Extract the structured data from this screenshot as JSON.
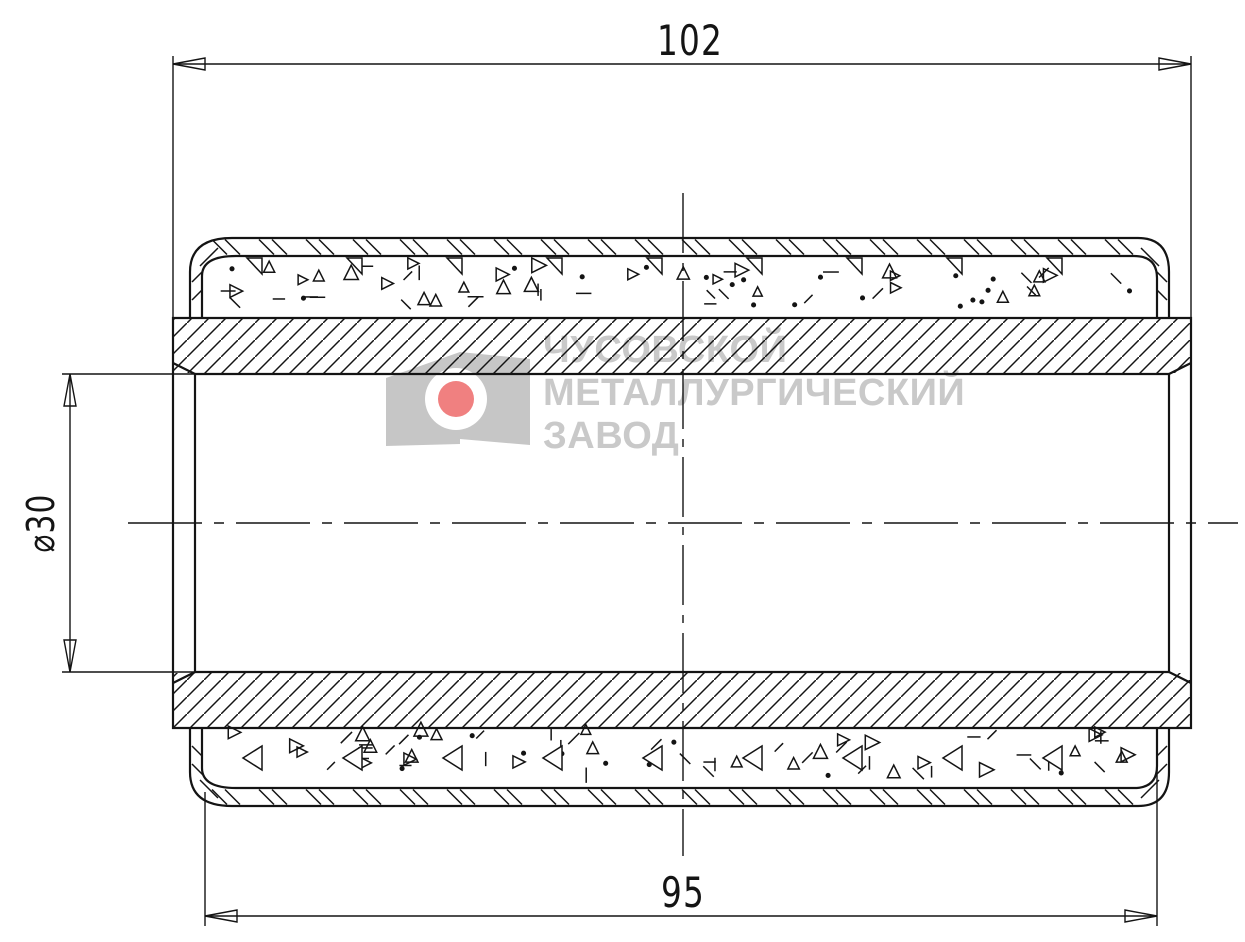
{
  "drawing": {
    "background": "#ffffff",
    "line_color": "#141414",
    "dimensions": {
      "overall_length": {
        "value": "102"
      },
      "outer_shell_length": {
        "value": "95"
      },
      "bore_diameter": {
        "value": "⌀30"
      }
    },
    "watermark": {
      "lines": [
        "ЧУСОВСКОЙ",
        "МЕТАЛЛУРГИЧЕСКИЙ",
        "ЗАВОД"
      ],
      "text_color": "#c9c9c9",
      "logo_gray": "#c6c6c6",
      "logo_red": "#f08080",
      "logo_white": "#ffffff"
    }
  }
}
